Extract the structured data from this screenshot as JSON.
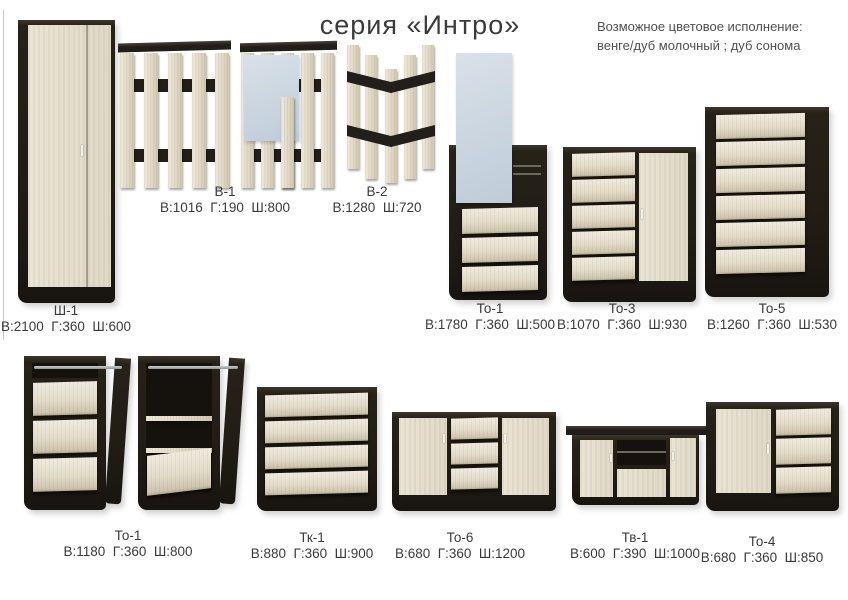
{
  "page": {
    "title": "серия «Интро»",
    "color_note": {
      "line1": "Возможное цветовое исполнение:",
      "line2": "венге/дуб молочный ;  дуб сонома"
    },
    "colors": {
      "wenge_dark": "#211d15",
      "milk_oak_light": "#e3dcca",
      "mirror_blue": "#ccd7e1",
      "background": "#ffffff",
      "text": "#3a3a3a"
    }
  },
  "products": [
    {
      "code": "Ш-1",
      "dims": "В:2100  Г:360  Ш:600"
    },
    {
      "code": "В-1",
      "dims": "В:1016  Г:190  Ш:800"
    },
    {
      "code": "В-2",
      "dims": "В:1280  Ш:720"
    },
    {
      "code": "То-1",
      "dims": "В:1780  Г:360  Ш:500"
    },
    {
      "code": "То-3",
      "dims": "В:1070  Г:360  Ш:930"
    },
    {
      "code": "То-5",
      "dims": "В:1260  Г:360  Ш:530"
    },
    {
      "code": "То-1",
      "dims": "В:1180  Г:360  Ш:800"
    },
    {
      "code": "Тк-1",
      "dims": "В:880  Г:360  Ш:900"
    },
    {
      "code": "То-6",
      "dims": "В:680  Г:360  Ш:1200"
    },
    {
      "code": "Тв-1",
      "dims": "В:600  Г:390  Ш:1000"
    },
    {
      "code": "То-4",
      "dims": "В:680  Г:360  Ш:850"
    }
  ]
}
